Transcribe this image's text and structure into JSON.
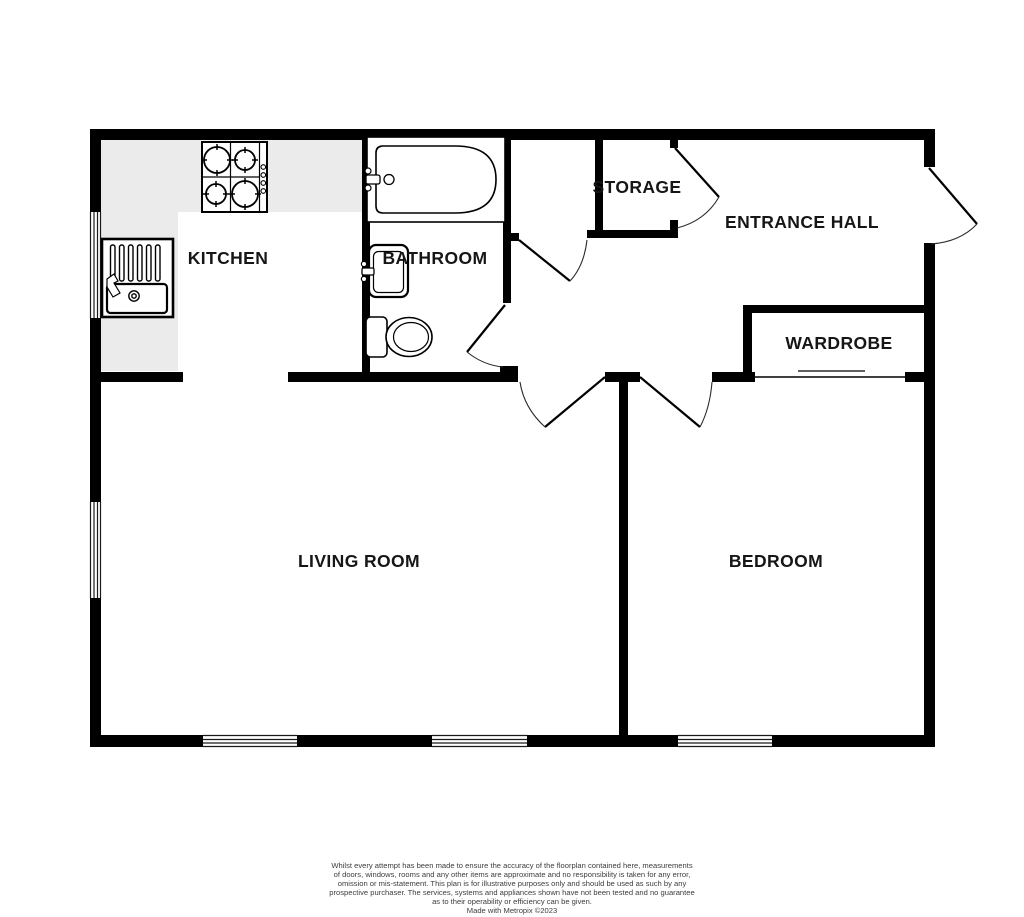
{
  "floorplan": {
    "rooms": [
      {
        "label": "KITCHEN"
      },
      {
        "label": "BATHROOM"
      },
      {
        "label": "STORAGE"
      },
      {
        "label": "ENTRANCE HALL"
      },
      {
        "label": "WARDROBE"
      },
      {
        "label": "LIVING ROOM"
      },
      {
        "label": "BEDROOM"
      }
    ],
    "fixtures": [
      {
        "name": "gas-hob"
      },
      {
        "name": "kitchen-sink"
      },
      {
        "name": "bathtub"
      },
      {
        "name": "washbasin"
      },
      {
        "name": "toilet"
      },
      {
        "name": "wardrobe-rail"
      }
    ],
    "colors": {
      "wall": "#000000",
      "counter": "#ebebeb",
      "floor": "#ffffff",
      "label_text": "#161616",
      "window_line": "#1a1a1a",
      "disclaimer_text": "#3d3d3d"
    },
    "disclaimer": {
      "lines": [
        "Whilst every attempt has been made to ensure the accuracy of the floorplan contained here, measurements",
        "of doors, windows, rooms and any other items are approximate and no responsibility is taken for any error,",
        "omission or mis-statement. This plan is for illustrative purposes only and should be used as such by any",
        "prospective purchaser. The services, systems and appliances shown have not been tested and no guarantee",
        "as to their operability or efficiency can be given."
      ],
      "credit": "Made with Metropix ©2023"
    }
  }
}
